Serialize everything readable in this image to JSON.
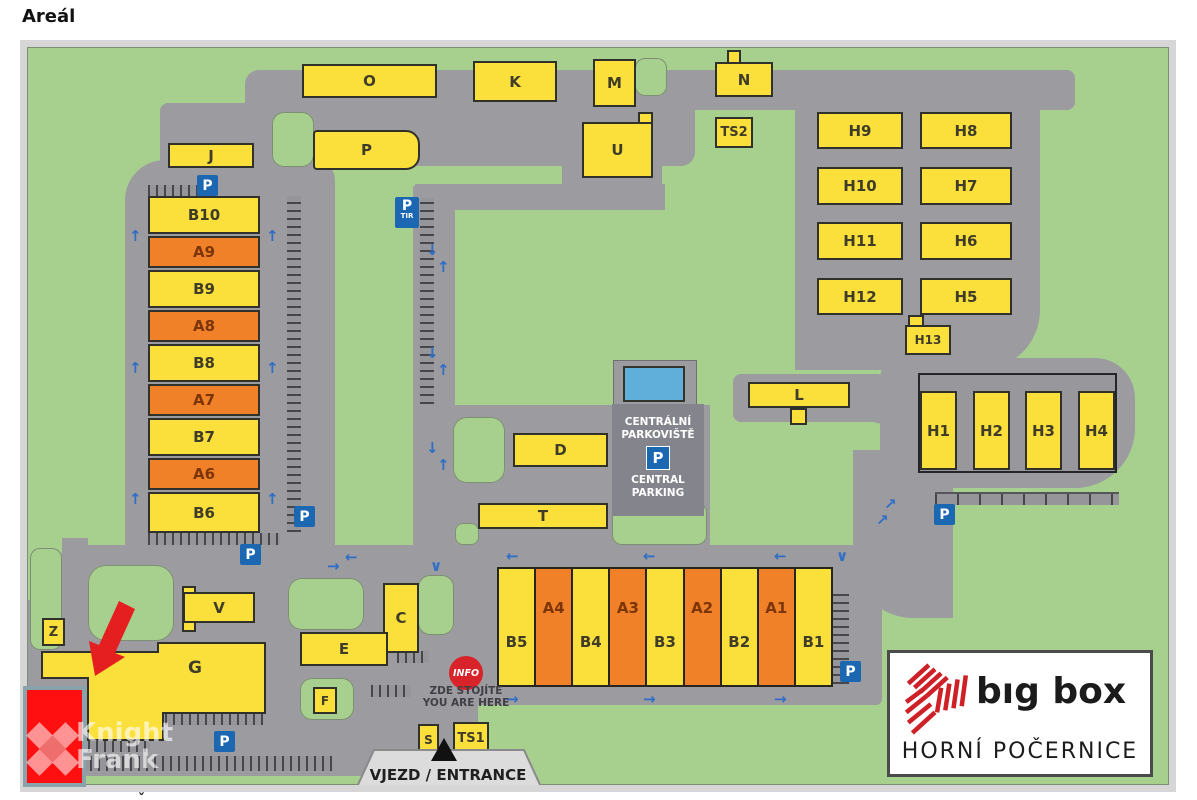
{
  "page": {
    "title": "Areál",
    "cutoff_mark": "ˇ"
  },
  "logo_box": {
    "brand": "bıg box",
    "location": "HORNÍ POČERNICE"
  },
  "watermark": {
    "line1": "Knight",
    "line2": "Frank"
  },
  "central_parking": {
    "line1": "CENTRÁLNÍ",
    "line2": "PARKOVIŠTĚ",
    "p": "P",
    "line3": "CENTRAL",
    "line4": "PARKING"
  },
  "info_marker": {
    "badge": "INFO",
    "line1": "ZDE STOJÍTE",
    "line2": "YOU ARE HERE"
  },
  "entrance": {
    "label": "VJEZD / ENTRANCE"
  },
  "colors": {
    "green": "#A7D08E",
    "road": "#9B9BA0",
    "light_road": "#DCDCDC",
    "yellow": "#FBE03C",
    "orange": "#F08128",
    "parking_dark": "#84848C",
    "pool_blue": "#5FAFDA",
    "sign_blue": "#1B67B2",
    "arrow_blue": "#2F6EC6",
    "highlight_red": "#FF0F0F",
    "arrow_red": "#E51E20",
    "brand_red": "#CE2127"
  },
  "map": {
    "buildings": [
      {
        "l": "J",
        "x": 168,
        "y": 143,
        "w": 86,
        "h": 25
      },
      {
        "l": "O",
        "x": 302,
        "y": 64,
        "w": 135,
        "h": 34
      },
      {
        "l": "P",
        "x": 313,
        "y": 130,
        "w": 107,
        "h": 40,
        "r": "4px 14px 14px 4px"
      },
      {
        "l": "K",
        "x": 473,
        "y": 61,
        "w": 84,
        "h": 41
      },
      {
        "l": "M",
        "x": 593,
        "y": 59,
        "w": 43,
        "h": 48
      },
      {
        "l": "N",
        "x": 715,
        "y": 62,
        "w": 58,
        "h": 35
      },
      {
        "l": "U",
        "x": 582,
        "y": 122,
        "w": 71,
        "h": 56
      },
      {
        "l": "TS2",
        "x": 715,
        "y": 117,
        "w": 38,
        "h": 31,
        "k": "box"
      },
      {
        "l": "B10",
        "x": 148,
        "y": 196,
        "w": 112,
        "h": 38
      },
      {
        "l": "A9",
        "x": 148,
        "y": 236,
        "w": 112,
        "h": 32,
        "k": "o"
      },
      {
        "l": "B9",
        "x": 148,
        "y": 270,
        "w": 112,
        "h": 38
      },
      {
        "l": "A8",
        "x": 148,
        "y": 310,
        "w": 112,
        "h": 32,
        "k": "o"
      },
      {
        "l": "B8",
        "x": 148,
        "y": 344,
        "w": 112,
        "h": 38
      },
      {
        "l": "A7",
        "x": 148,
        "y": 384,
        "w": 112,
        "h": 32,
        "k": "o"
      },
      {
        "l": "B7",
        "x": 148,
        "y": 418,
        "w": 112,
        "h": 38
      },
      {
        "l": "A6",
        "x": 148,
        "y": 458,
        "w": 112,
        "h": 32,
        "k": "o"
      },
      {
        "l": "B6",
        "x": 148,
        "y": 492,
        "w": 112,
        "h": 41
      },
      {
        "l": "H9",
        "x": 817,
        "y": 112,
        "w": 86,
        "h": 37
      },
      {
        "l": "H8",
        "x": 920,
        "y": 112,
        "w": 92,
        "h": 37
      },
      {
        "l": "H10",
        "x": 817,
        "y": 167,
        "w": 86,
        "h": 38
      },
      {
        "l": "H7",
        "x": 920,
        "y": 167,
        "w": 92,
        "h": 38
      },
      {
        "l": "H11",
        "x": 817,
        "y": 222,
        "w": 86,
        "h": 38
      },
      {
        "l": "H6",
        "x": 920,
        "y": 222,
        "w": 92,
        "h": 38
      },
      {
        "l": "H12",
        "x": 817,
        "y": 278,
        "w": 86,
        "h": 37
      },
      {
        "l": "H5",
        "x": 920,
        "y": 278,
        "w": 92,
        "h": 37
      },
      {
        "l": "H13",
        "x": 905,
        "y": 325,
        "w": 46,
        "h": 30,
        "fs": 12
      },
      {
        "l": "L",
        "x": 748,
        "y": 382,
        "w": 102,
        "h": 26
      },
      {
        "l": "D",
        "x": 513,
        "y": 433,
        "w": 95,
        "h": 34
      },
      {
        "l": "T",
        "x": 478,
        "y": 503,
        "w": 130,
        "h": 26
      },
      {
        "l": "C",
        "x": 383,
        "y": 583,
        "w": 36,
        "h": 70
      },
      {
        "l": "E",
        "x": 300,
        "y": 632,
        "w": 88,
        "h": 34
      },
      {
        "l": "V",
        "x": 183,
        "y": 592,
        "w": 72,
        "h": 31
      },
      {
        "l": "Z",
        "x": 42,
        "y": 618,
        "w": 23,
        "h": 28,
        "k": "box",
        "fs": 13
      },
      {
        "l": "F",
        "x": 313,
        "y": 687,
        "w": 24,
        "h": 27,
        "k": "box",
        "fs": 12
      },
      {
        "l": "S",
        "x": 418,
        "y": 724,
        "w": 21,
        "h": 31,
        "k": "box",
        "fs": 12
      },
      {
        "l": "TS1",
        "x": 453,
        "y": 722,
        "w": 36,
        "h": 32,
        "k": "box"
      },
      {
        "l": "H1",
        "x": 920,
        "y": 391,
        "w": 37,
        "h": 79
      },
      {
        "l": "H2",
        "x": 973,
        "y": 391,
        "w": 37,
        "h": 79
      },
      {
        "l": "H3",
        "x": 1025,
        "y": 391,
        "w": 37,
        "h": 79
      },
      {
        "l": "H4",
        "x": 1078,
        "y": 391,
        "w": 37,
        "h": 79
      }
    ],
    "parts": [
      [
        727,
        50,
        14,
        14
      ],
      [
        638,
        112,
        15,
        12
      ],
      [
        790,
        408,
        17,
        17
      ],
      [
        182,
        586,
        14,
        46
      ],
      [
        908,
        315,
        16,
        12
      ]
    ],
    "row": {
      "x": 497,
      "y": 567,
      "w": 336,
      "h": 120,
      "cols": [
        {
          "l": "B5",
          "k": "y"
        },
        {
          "l": "A4",
          "k": "o"
        },
        {
          "l": "B4",
          "k": "y"
        },
        {
          "l": "A3",
          "k": "o"
        },
        {
          "l": "B3",
          "k": "y"
        },
        {
          "l": "A2",
          "k": "o"
        },
        {
          "l": "B2",
          "k": "y"
        },
        {
          "l": "A1",
          "k": "o"
        },
        {
          "l": "B1",
          "k": "y"
        }
      ]
    },
    "roads": [
      [
        245,
        70,
        450,
        96,
        "14px"
      ],
      [
        660,
        70,
        415,
        40,
        "8px"
      ],
      [
        795,
        90,
        245,
        280,
        "0 0 60px 0"
      ],
      [
        160,
        103,
        105,
        66,
        "8px"
      ],
      [
        125,
        160,
        210,
        405,
        "40px 20px 0 0"
      ],
      [
        413,
        186,
        42,
        368,
        "0"
      ],
      [
        562,
        98,
        100,
        110,
        "8px"
      ],
      [
        415,
        184,
        250,
        26,
        "0"
      ],
      [
        413,
        405,
        297,
        150,
        "30px 0 0 0"
      ],
      [
        733,
        374,
        152,
        48,
        "8px"
      ],
      [
        880,
        358,
        255,
        130,
        "20px 40px 60px 20px"
      ],
      [
        853,
        450,
        100,
        168,
        "0 0 0 60px"
      ],
      [
        55,
        545,
        827,
        76,
        "25px 0 0 5px"
      ],
      [
        450,
        545,
        432,
        160,
        "6px"
      ],
      [
        28,
        600,
        450,
        176,
        "0 0 0 20px"
      ],
      [
        62,
        538,
        26,
        126,
        "0"
      ],
      [
        420,
        688,
        34,
        66,
        "0"
      ],
      [
        845,
        385,
        85,
        40,
        "8px",
        15
      ]
    ],
    "islands": [
      [
        272,
        112,
        42,
        55,
        12
      ],
      [
        635,
        58,
        32,
        38,
        10
      ],
      [
        453,
        417,
        52,
        66,
        14
      ],
      [
        455,
        523,
        24,
        22,
        8
      ],
      [
        88,
        565,
        86,
        76,
        18
      ],
      [
        30,
        548,
        32,
        102,
        10
      ],
      [
        288,
        578,
        76,
        52,
        14
      ],
      [
        418,
        575,
        36,
        60,
        12
      ],
      [
        300,
        678,
        54,
        42,
        12
      ],
      [
        28,
        738,
        48,
        48,
        8
      ],
      [
        612,
        503,
        95,
        42,
        10
      ]
    ],
    "hatches": [
      [
        148,
        185,
        52,
        11,
        "h"
      ],
      [
        287,
        196,
        14,
        336,
        "v"
      ],
      [
        148,
        533,
        132,
        12,
        "h"
      ],
      [
        420,
        198,
        14,
        206,
        "v"
      ],
      [
        833,
        594,
        16,
        90,
        "v"
      ],
      [
        935,
        492,
        184,
        13,
        "hs"
      ],
      [
        165,
        712,
        98,
        13,
        "h"
      ],
      [
        88,
        741,
        62,
        11,
        "h"
      ],
      [
        74,
        756,
        258,
        15,
        "h"
      ],
      [
        397,
        651,
        32,
        12,
        "h"
      ],
      [
        371,
        685,
        40,
        12,
        "h"
      ]
    ],
    "h_group": [
      918,
      373,
      199,
      100
    ],
    "parking": {
      "top": [
        613,
        360,
        84,
        46
      ],
      "pool": [
        623,
        366,
        62,
        36
      ],
      "block": [
        612,
        404,
        92,
        100
      ]
    },
    "p_signs": [
      [
        197,
        175
      ],
      [
        294,
        506
      ],
      [
        240,
        544
      ],
      [
        840,
        661
      ],
      [
        934,
        504
      ],
      [
        214,
        731
      ]
    ],
    "p_sign_label": "P",
    "p_tir": {
      "x": 395,
      "y": 197,
      "p": "P",
      "sub": "TIR"
    },
    "arrows": [
      [
        "↑",
        129,
        229
      ],
      [
        "↑",
        266,
        229
      ],
      [
        "↑",
        129,
        361
      ],
      [
        "↑",
        266,
        361
      ],
      [
        "↑",
        129,
        492
      ],
      [
        "↑",
        266,
        492
      ],
      [
        "↓",
        426,
        243
      ],
      [
        "↑",
        437,
        260
      ],
      [
        "↓",
        426,
        346
      ],
      [
        "↑",
        437,
        363
      ],
      [
        "↓",
        426,
        441
      ],
      [
        "↑",
        437,
        458
      ],
      [
        "←",
        345,
        550
      ],
      [
        "→",
        327,
        559
      ],
      [
        "←",
        506,
        549
      ],
      [
        "←",
        643,
        549
      ],
      [
        "←",
        774,
        549
      ],
      [
        "→",
        506,
        692
      ],
      [
        "→",
        643,
        692
      ],
      [
        "→",
        774,
        692
      ],
      [
        "∨",
        836,
        549
      ],
      [
        "∨",
        430,
        559
      ],
      [
        "↗",
        876,
        513
      ],
      [
        "↗",
        884,
        497
      ]
    ],
    "g_building": {
      "label": "G",
      "points": "42,652 158,652 158,643 265,643 265,713 163,713 163,740 88,740 88,678 42,678",
      "lx": 180,
      "ly": 662
    },
    "entrance_shape": {
      "poly": "374,750 524,750 542,789 356,789",
      "tri": "444,738 431,761 457,761",
      "tx": 348,
      "ty": 766
    },
    "red_arrow": "95,676 89,641 99,645 119,601 135,609 115,653 125,657",
    "highlight_building": [
      23,
      686,
      63,
      101
    ],
    "info_pos": [
      449,
      656
    ],
    "info_text_pos": [
      406,
      685
    ],
    "watermark_pos": [
      24,
      712
    ],
    "logo_pos": [
      887,
      650,
      266,
      127
    ]
  }
}
